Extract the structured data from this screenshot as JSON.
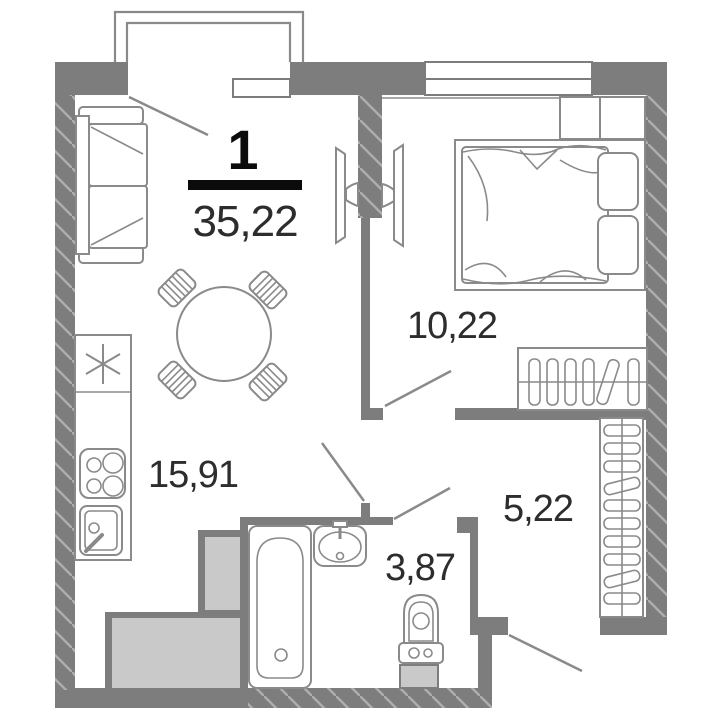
{
  "apartment": {
    "rooms_count_label": "1",
    "total_area_label": "35,22"
  },
  "rooms": {
    "kitchen_living": {
      "area_label": "15,91"
    },
    "bedroom": {
      "area_label": "10,22"
    },
    "hallway": {
      "area_label": "5,22"
    },
    "bathroom": {
      "area_label": "3,87"
    }
  },
  "colors": {
    "background": "#ffffff",
    "wall_gray": "#7d7d7d",
    "wall_hatch_line": "#aeaeae",
    "outline_gray": "#8a8a8a",
    "duct_fill": "#c9c9c9",
    "label_text": "#2d2d2d",
    "accent_black": "#0b0b0b"
  },
  "furniture_icons": [
    "sofa-icon",
    "dining-table-icon",
    "chair-icon",
    "fridge-icon",
    "stove-icon",
    "kitchen-sink-icon",
    "tv-icon",
    "bed-icon",
    "pillow-icon",
    "nightstand-icon",
    "wardrobe-icon",
    "closet-icon",
    "bathtub-icon",
    "washbasin-icon",
    "toilet-icon",
    "window-icon",
    "door-swing-icon",
    "balcony-icon"
  ]
}
